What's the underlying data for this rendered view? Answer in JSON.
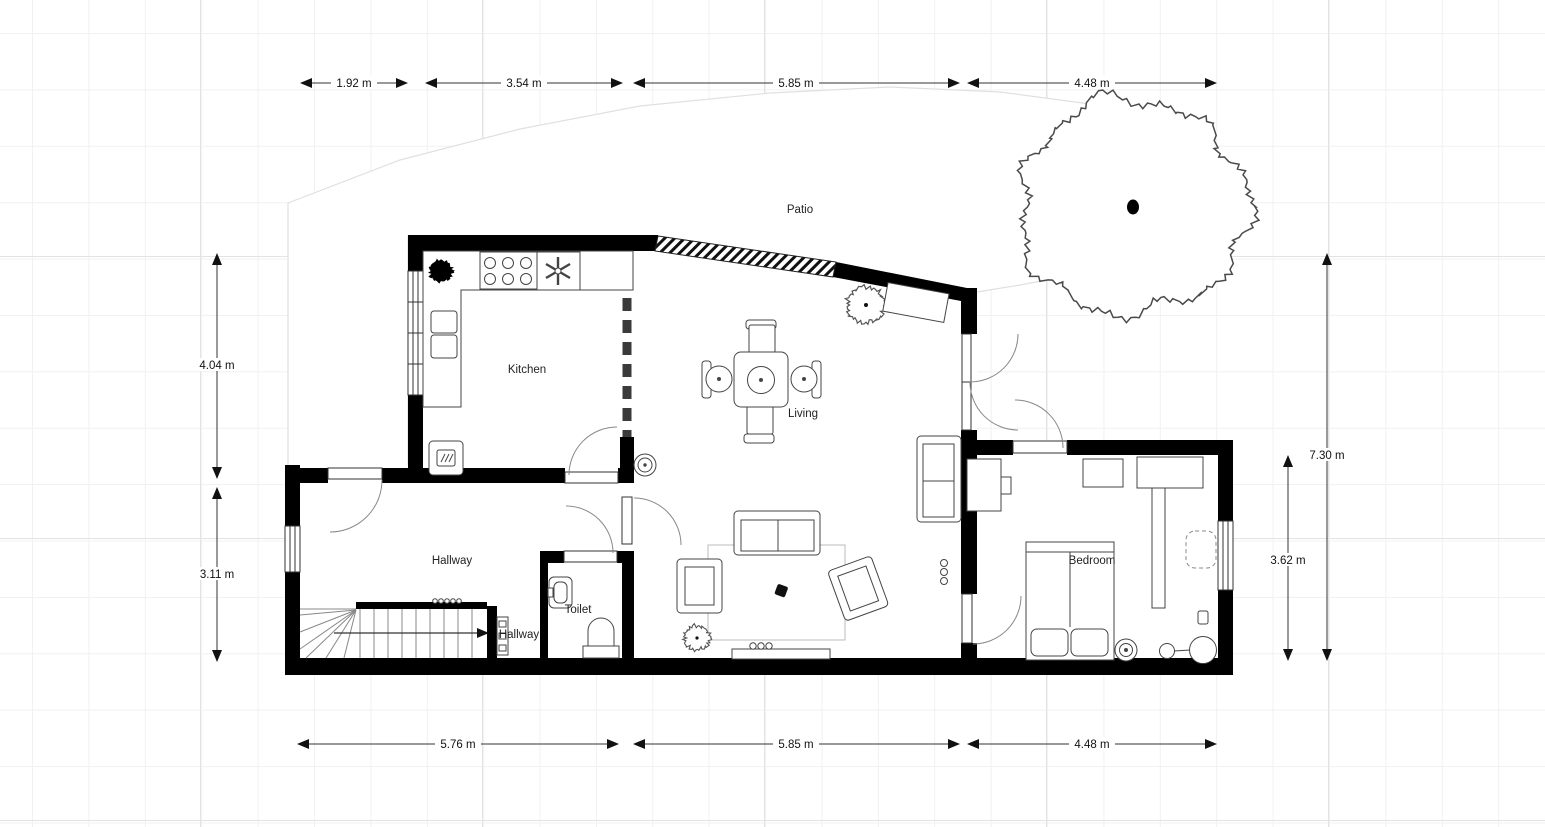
{
  "rooms": {
    "patio": "Patio",
    "kitchen": "Kitchen",
    "living": "Living",
    "hallway": "Hallway",
    "toilet": "Toilet",
    "hallway_small": "Hallway",
    "bedroom": "Bedroom"
  },
  "dimensions": {
    "top": [
      "1.92 m",
      "3.54 m",
      "5.85 m",
      "4.48 m"
    ],
    "bottom": [
      "5.76 m",
      "5.85 m",
      "4.48 m"
    ],
    "left": [
      "4.04 m",
      "3.11 m"
    ],
    "right": [
      "7.30 m",
      "3.62 m"
    ]
  },
  "colors": {
    "wall": "#000000",
    "grid_minor": "#f1f1f1",
    "grid_major": "#e3e3e3",
    "door_arc": "#888888",
    "furniture_outline": "#444444",
    "patio_outline": "#e0e0e0"
  }
}
